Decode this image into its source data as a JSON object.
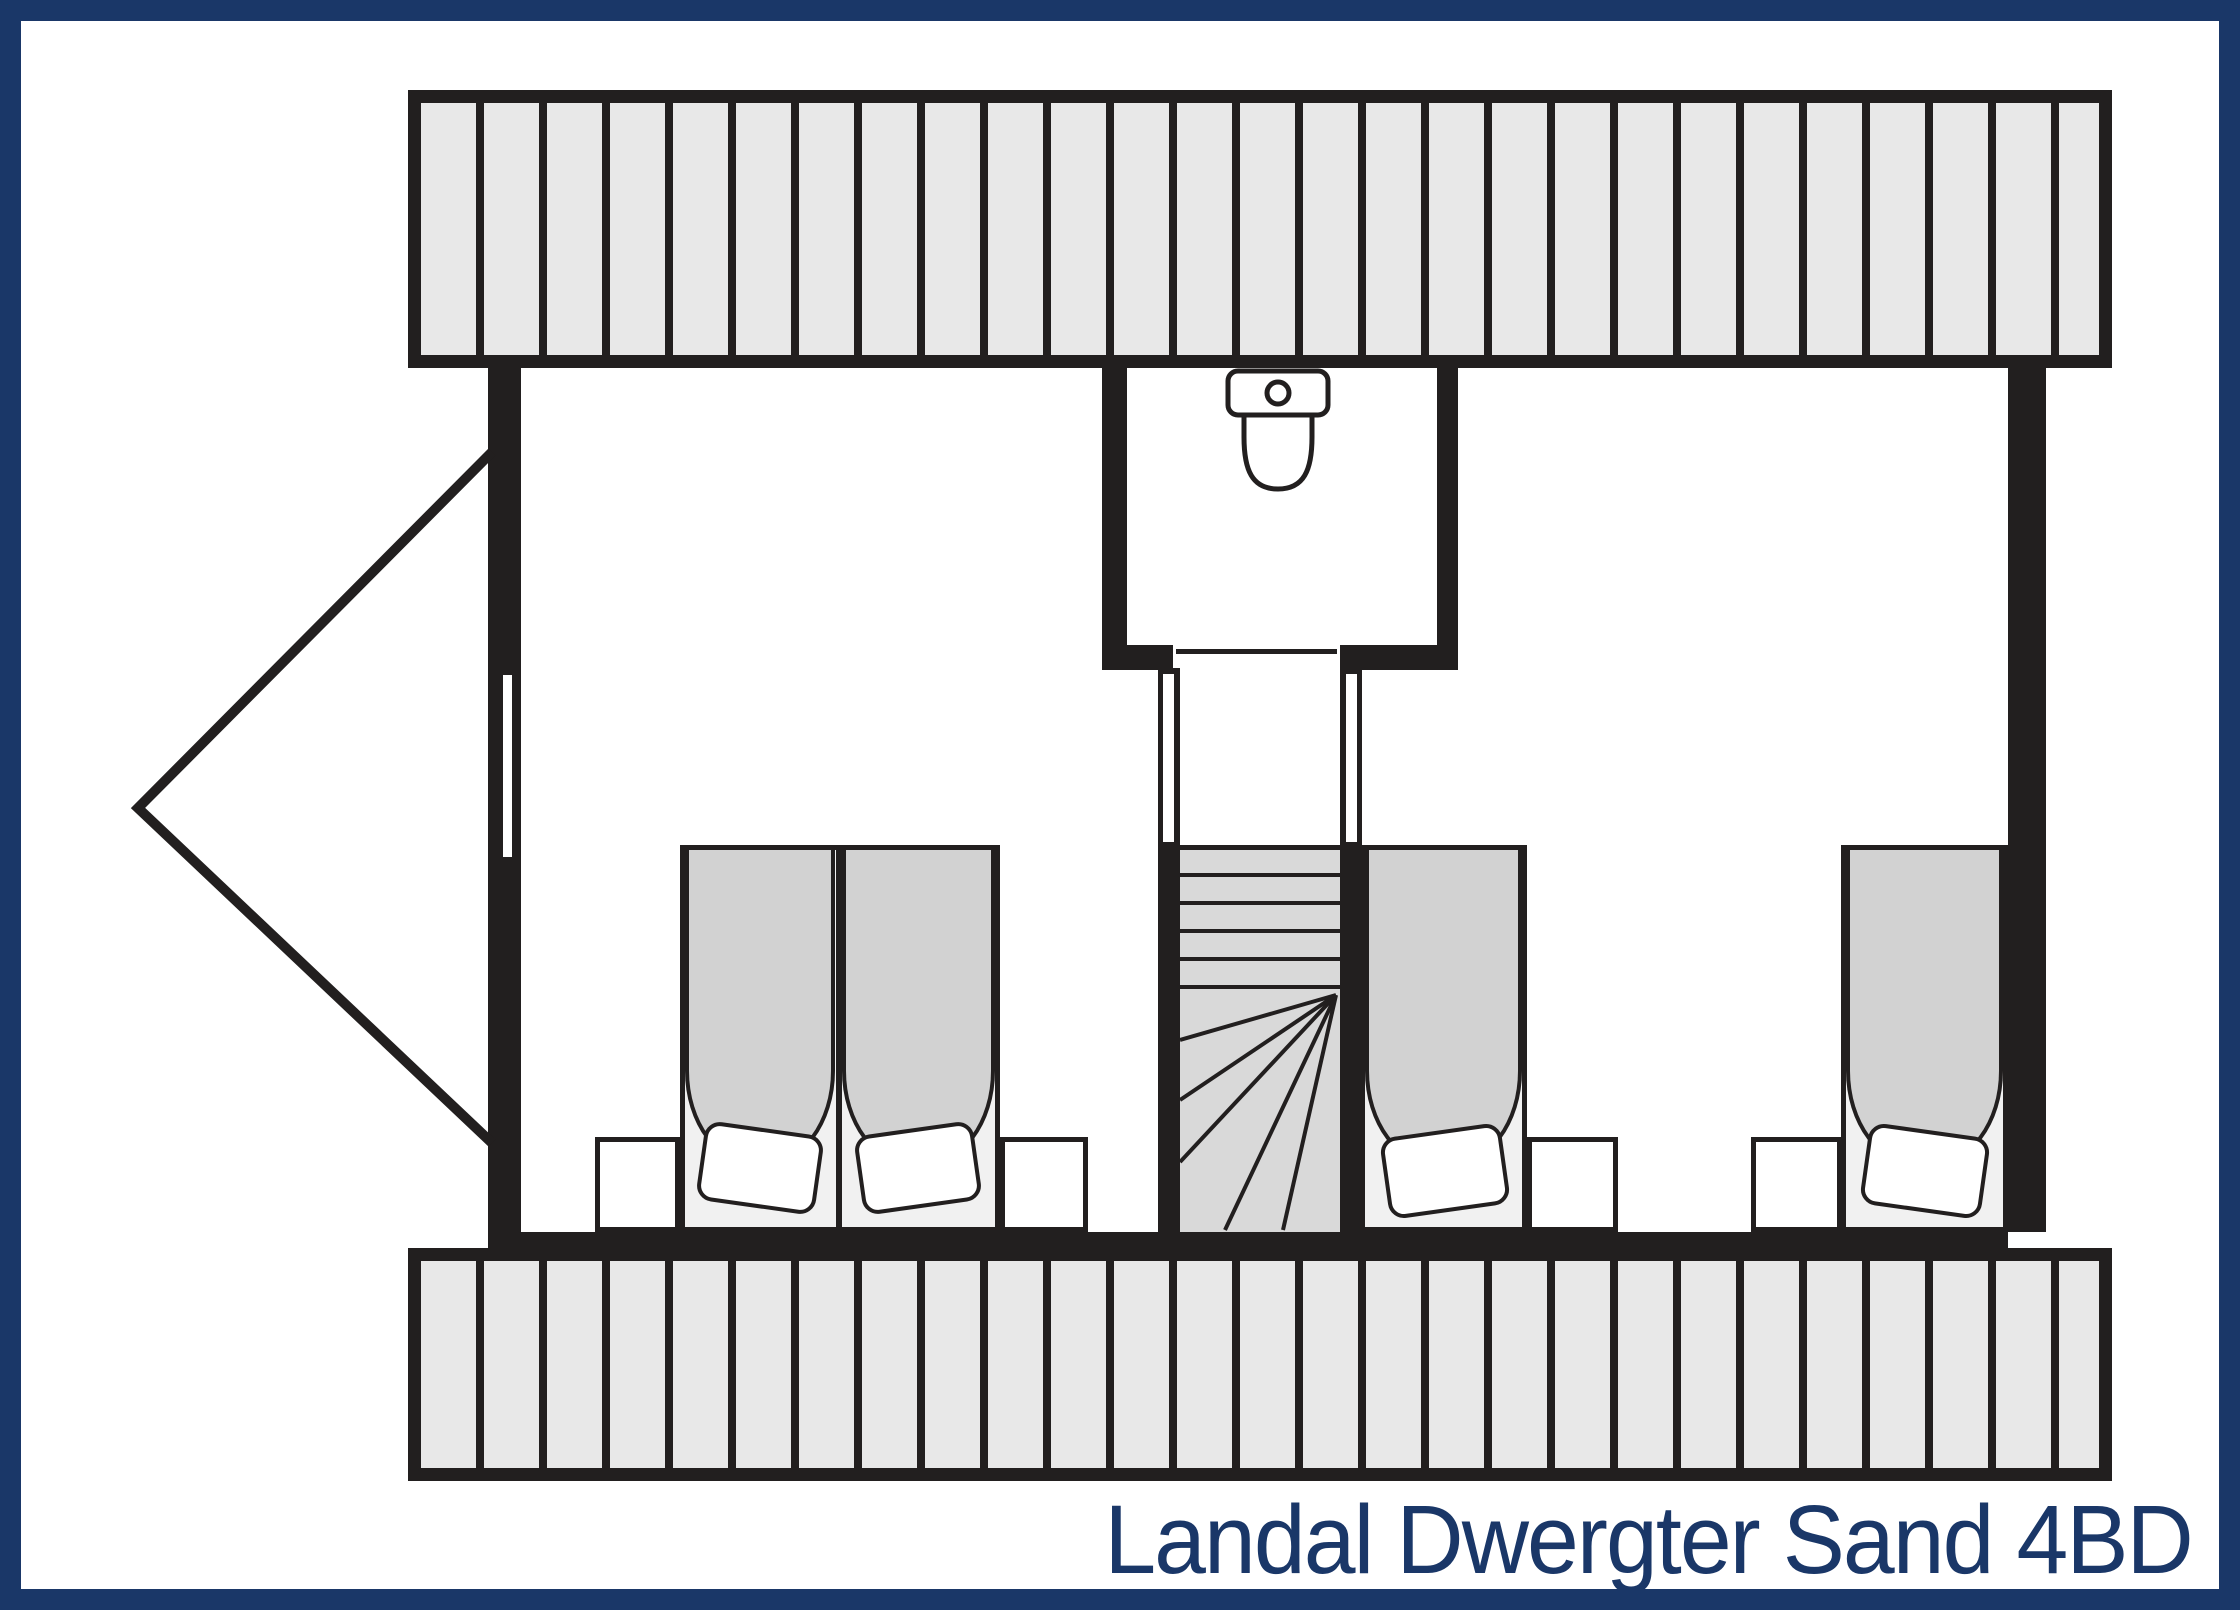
{
  "title": {
    "text": "Landal Dwergter Sand 4BD"
  },
  "colors": {
    "frame_navy": "#1a3768",
    "ink": "#221f1f",
    "hatch_fill": "#e8e8e8",
    "duvet_gray": "#d2d2d2",
    "stair_gray": "#d9d9d9",
    "bed_base": "#f1f1f1",
    "pillow_white": "#ffffff",
    "background": "#ffffff"
  },
  "plan": {
    "kind": "floor-plan-upper-floor",
    "bed_count": 4,
    "elements": [
      "roof-hatch-band-top",
      "roof-hatch-band-bottom",
      "gable-outline-left",
      "window-left-wall",
      "wc-room-with-toilet",
      "wc-door",
      "stair-landing",
      "winder-staircase",
      "bedroom-door-left",
      "bedroom-door-right",
      "double-bed-two-singles",
      "single-bed-middle",
      "single-bed-right",
      "nightstand-x4"
    ]
  }
}
